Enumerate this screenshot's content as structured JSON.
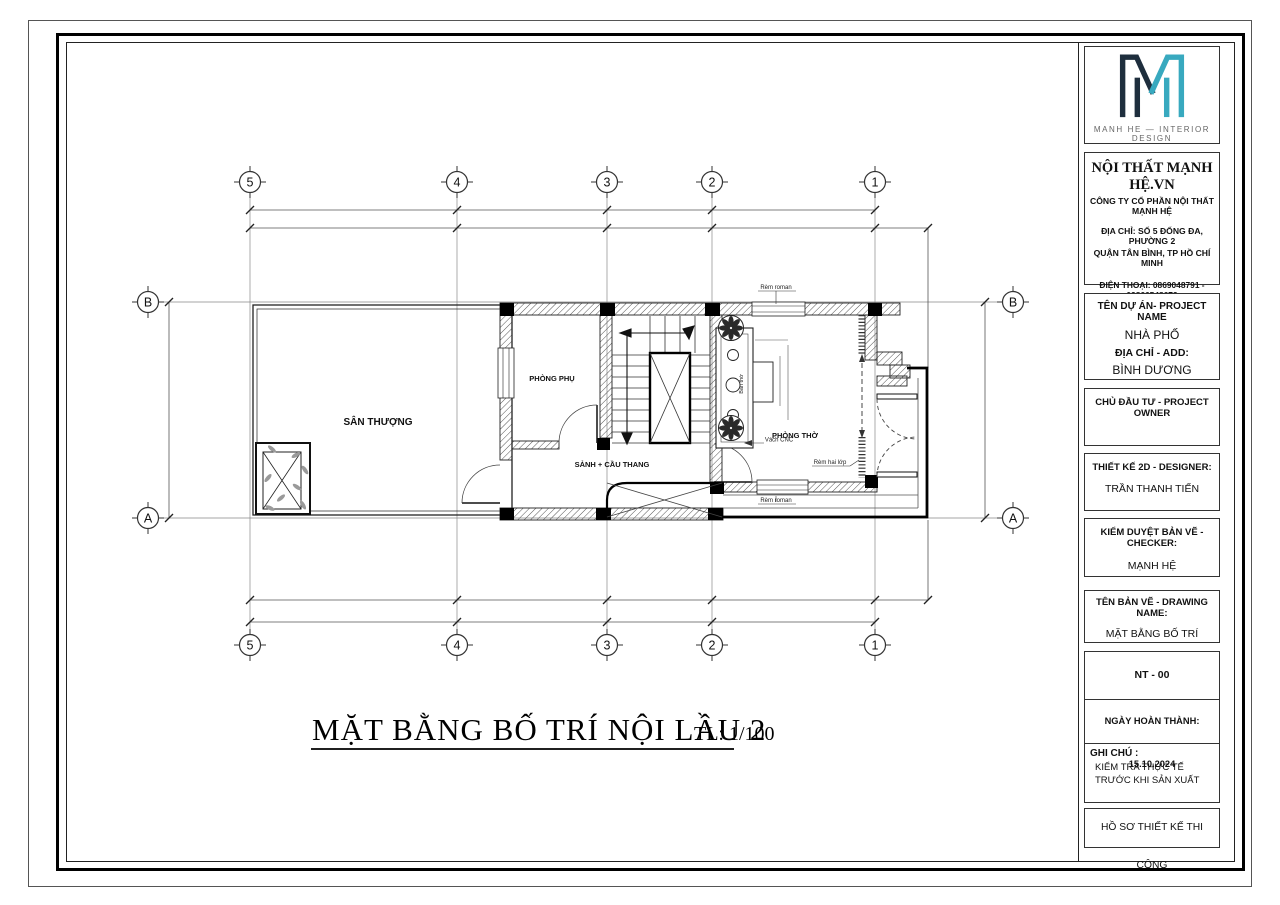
{
  "title": {
    "main": "MẶT BẰNG BỐ TRÍ NỘI LẦU 2",
    "scale": "TL: 1/100"
  },
  "logo": {
    "brand": "MANH HE — INTERIOR DESIGN",
    "color_dark": "#1e2e3d",
    "color_teal": "#38a9bf"
  },
  "company": {
    "name": "NỘI THẤT MẠNH HỆ.VN",
    "legal": "CÔNG TY CỔ PHẦN NỘI THẤT MẠNH HỆ",
    "address1": "ĐỊA CHỈ: SỐ 5 ĐỐNG ĐA, PHƯỜNG 2",
    "address2": "QUẬN TÂN BÌNH, TP HỒ CHÍ MINH",
    "phone": "ĐIỆN THOẠI: 0869048791  -  02866548679",
    "website": "WEBSITE:NOITHATMANHHE.VN",
    "email": "EMAIL: TUVAN@NOITHATMANHHE.VN"
  },
  "titleblock": {
    "project_label": "TÊN DỰ ÁN- PROJECT NAME",
    "project_name": "NHÀ PHỐ",
    "address_label": "ĐỊA CHỈ - ADD:",
    "address_value": "BÌNH DƯƠNG",
    "owner_label": "CHỦ ĐẦU TƯ - PROJECT OWNER",
    "designer_label": "THIẾT KẾ 2D - DESIGNER:",
    "designer_name": "TRẦN THANH TIẾN",
    "checker_label": "KIỂM DUYỆT BẢN VẼ - CHECKER:",
    "checker_name": "MẠNH HỆ",
    "drawing_label": "TÊN BẢN VẼ - DRAWING NAME:",
    "drawing_name": "MẶT BẰNG BỐ TRÍ",
    "sheet_code": "NT - 00",
    "date_line": "NGÀY HOÀN THÀNH: 15.10.2024",
    "note_label": "GHI CHÚ :",
    "note_line1": "KIỂM TRA THỰC TẾ",
    "note_line2": "TRƯỚC KHI SẢN XUẤT",
    "footer": "HỒ SƠ THIẾT KẾ THI CÔNG"
  },
  "plan": {
    "grid_cols": [
      "5",
      "4",
      "3",
      "2",
      "1"
    ],
    "grid_rows": [
      "B",
      "A"
    ],
    "labels": {
      "san_thuong": "SÂN THƯỢNG",
      "phong_phu": "PHÒNG PHỤ",
      "sanh_cau_thang": "SẢNH + CẦU THANG",
      "phong_tho": "PHÒNG THỜ",
      "rem_roman_top": "Rèm roman",
      "rem_roman_bottom": "Rèm roman",
      "rem_hai_lop": "Rèm hai lớp",
      "vach_cnc": "Vách CNC",
      "ban_tho": "Bàn thờ"
    }
  }
}
